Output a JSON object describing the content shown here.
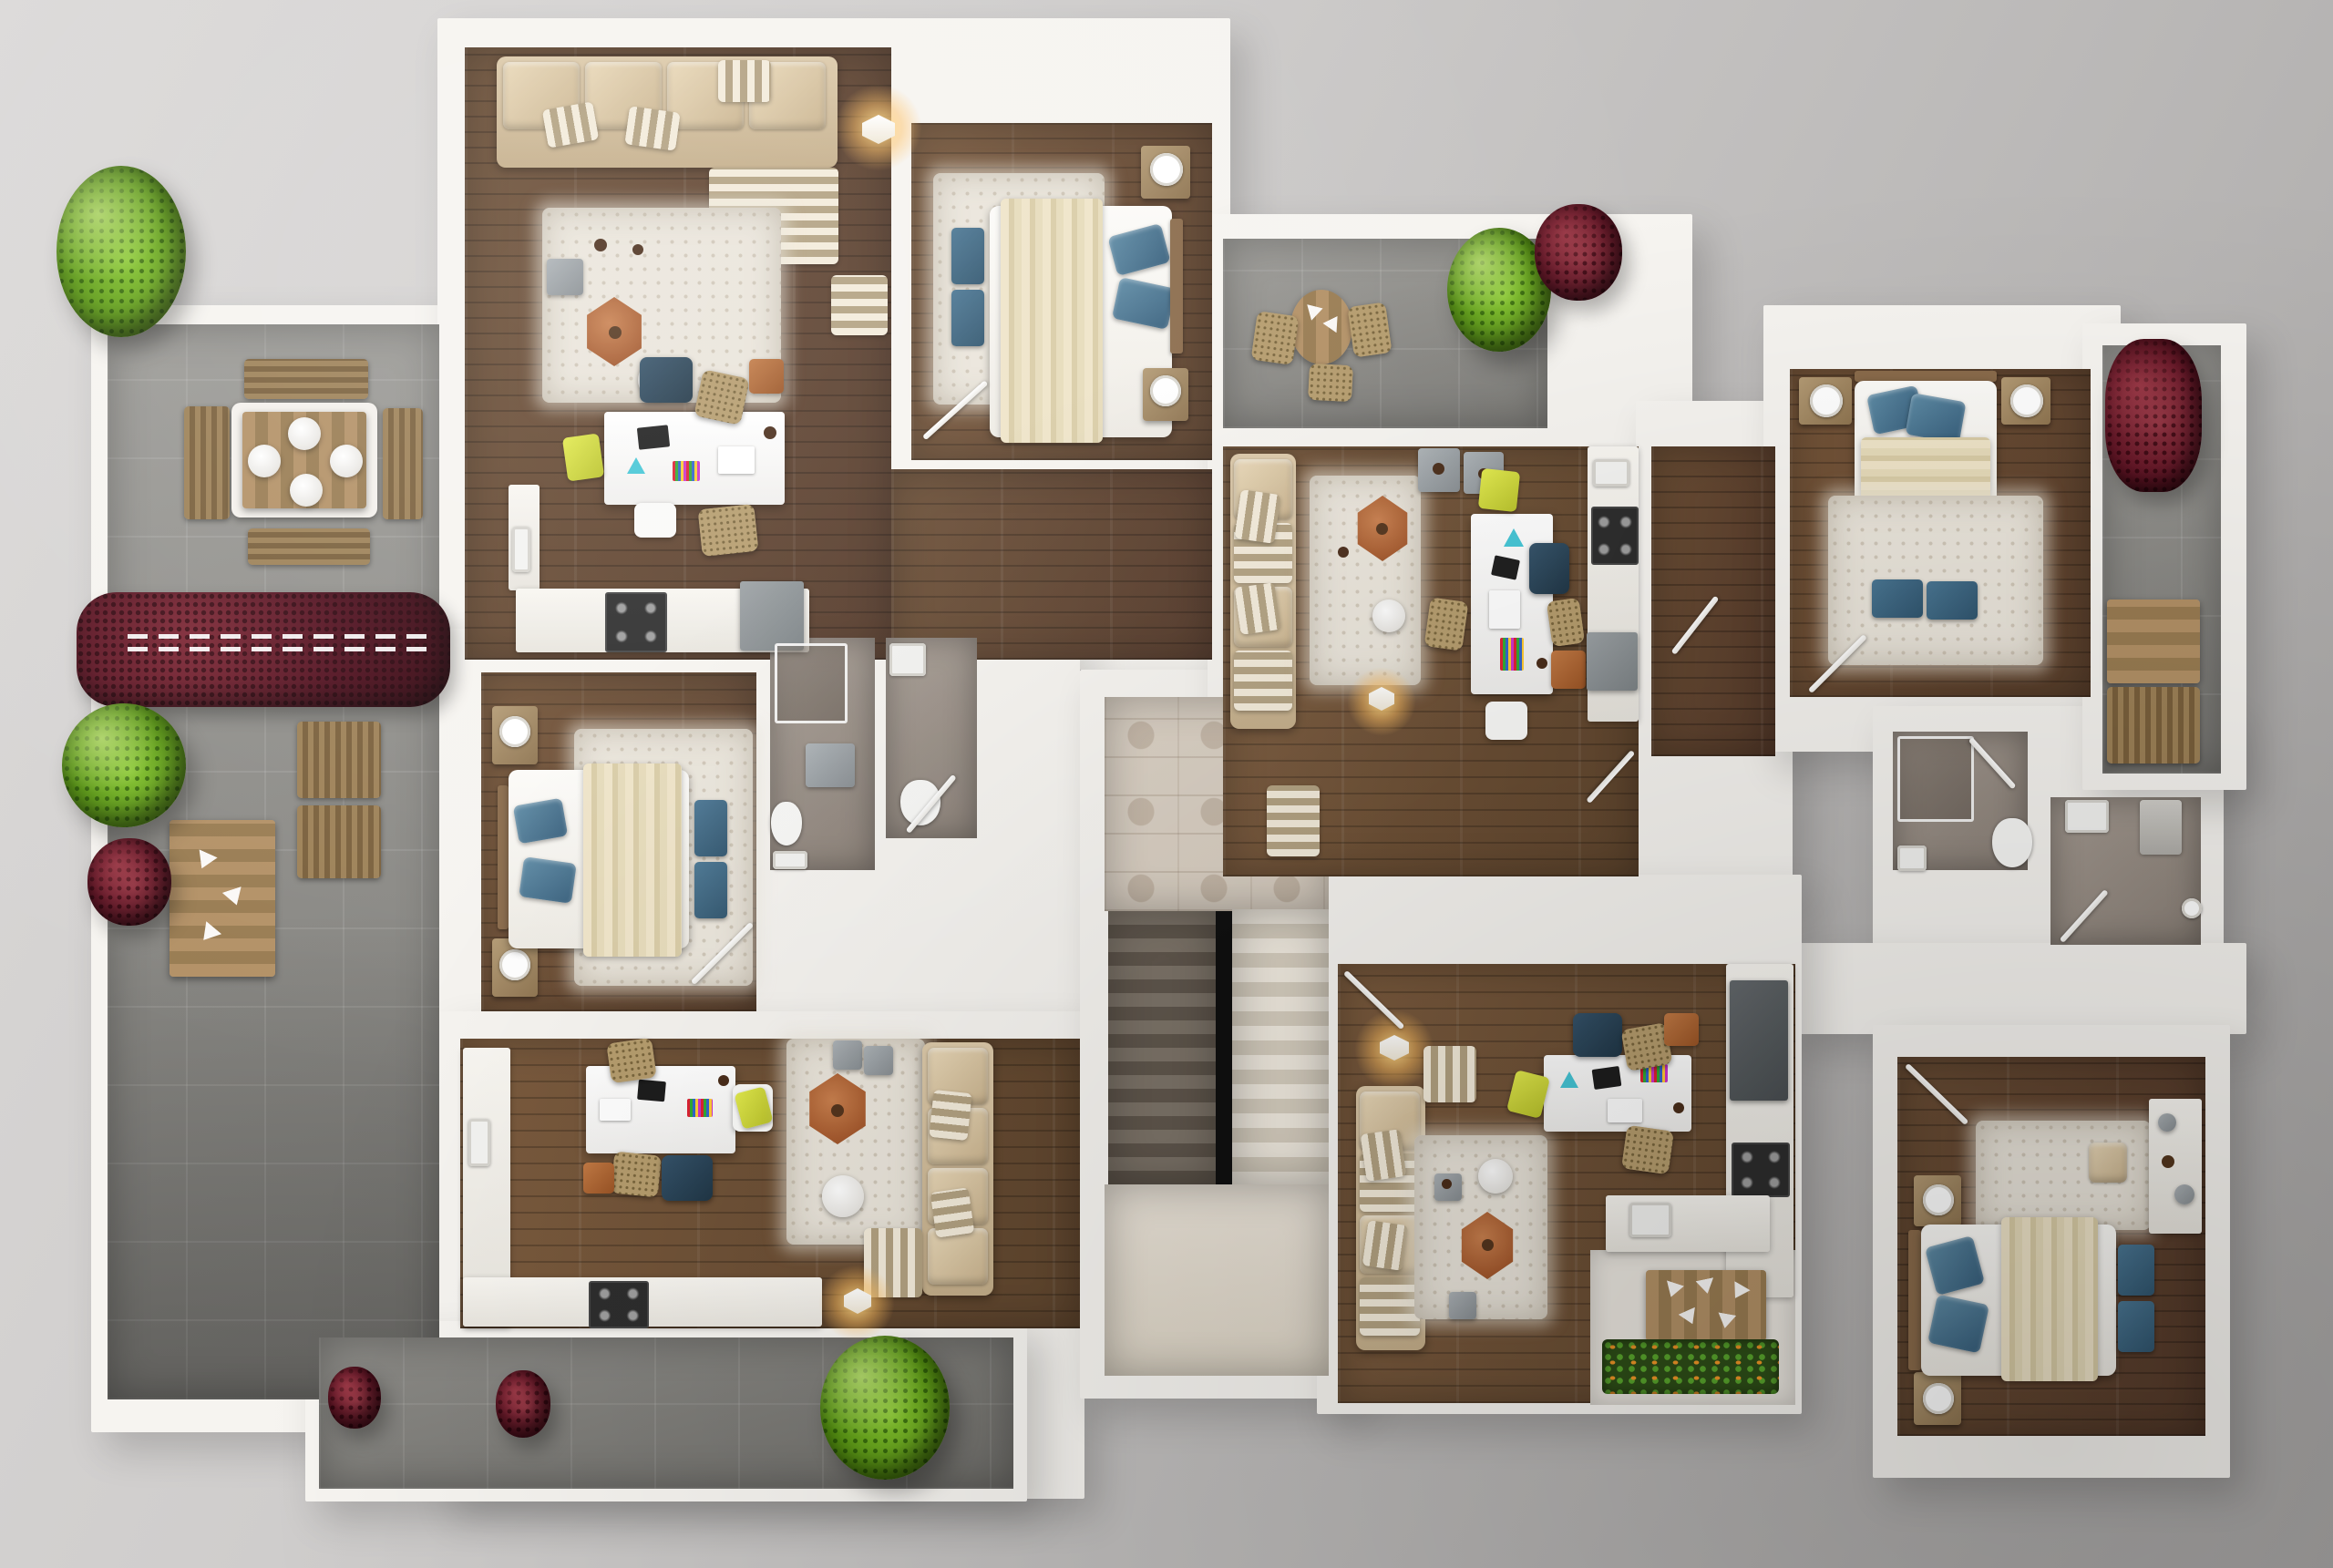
{
  "page": {
    "title": "3D Apartment Floor Plan — Top-Down Render"
  },
  "scene": {
    "kind": "photorealistic top-down 3D floor plan of a multi-apartment residential storey",
    "background_color": "#c6c4c3",
    "wall_color": "#f6f4f0",
    "no_visible_text": true
  },
  "palette": {
    "hardwood_dark": "#5f452f",
    "hardwood_mid": "#6d4f37",
    "hardwood_light": "#72543a",
    "terrace_tile_gray": "#8e8d89",
    "stair_hall_tile_beige": "#d9cfc2",
    "bathroom_floor_taupe": "#9a9088",
    "shag_rug_cream": "#eae5db",
    "sofa_beige": "#d5c1a1",
    "stripe_fabric": "#b2a181",
    "pillow_blue": "#44718f",
    "blanket_cream": "#e3d8ba",
    "coffee_table_terracotta": "#b06136",
    "accent_yellow": "#d8e03e",
    "accent_teal": "#45c6d6",
    "plant_green": "#65a415",
    "plant_dark_red": "#5e1323",
    "appliance_gray": "#8e9296",
    "stove_black": "#2d2d2d",
    "furniture_oak": "#a98d66"
  },
  "rooms": [
    {
      "id": "terrace-left",
      "floor": "gray tile",
      "contents": [
        "square dining table with 4 plates",
        "4 slat benches",
        "boxwood bushes",
        "red maple hedge with railing",
        "cube seats",
        "plank table"
      ]
    },
    {
      "id": "living-top-left",
      "floor": "hardwood",
      "contents": [
        "L-shaped beige sofa with striped pillows",
        "shag rug",
        "hexagonal terracotta coffee table",
        "white side table",
        "work desk with chairs",
        "wall lamp"
      ]
    },
    {
      "id": "bedroom-top-middle",
      "floor": "hardwood",
      "contents": [
        "double bed with blue pillows",
        "two nightstands with lamps",
        "shag rug",
        "two blue ottomans"
      ]
    },
    {
      "id": "kitchen-top-left",
      "floor": "hardwood",
      "contents": [
        "counter",
        "gas stove",
        "fridge"
      ]
    },
    {
      "id": "bedroom-left",
      "floor": "hardwood",
      "contents": [
        "double bed",
        "rug",
        "nightstands",
        "blue ottomans"
      ]
    },
    {
      "id": "bathroom-left-1",
      "floor": "taupe tile",
      "contents": [
        "shower",
        "vanity",
        "toilet",
        "sink"
      ]
    },
    {
      "id": "bathroom-left-2",
      "floor": "taupe tile",
      "contents": [
        "sink",
        "toilet"
      ]
    },
    {
      "id": "living-bottom-left",
      "floor": "hardwood",
      "contents": [
        "desk with chairs",
        "kitchen counters with stove",
        "rug",
        "hex coffee table",
        "L-sofa",
        "floor lamp"
      ]
    },
    {
      "id": "stair-hall",
      "floor": "beige tile",
      "contents": [
        "U-shaped staircase, two flights",
        "landing"
      ]
    },
    {
      "id": "terrace-top-right",
      "floor": "gray tile",
      "contents": [
        "round table",
        "wicker chairs",
        "green bush",
        "red plant"
      ]
    },
    {
      "id": "living-center-right",
      "floor": "hardwood",
      "contents": [
        "striped sofa",
        "rug",
        "hex table",
        "desk",
        "kitchen strip with stove and fridge",
        "floor lamp"
      ]
    },
    {
      "id": "bedroom-top-right",
      "floor": "hardwood",
      "contents": [
        "double bed",
        "nightstands with lamps",
        "rug",
        "blue ottomans"
      ]
    },
    {
      "id": "balcony-right",
      "floor": "gray tile",
      "contents": [
        "red plant",
        "wooden cabinets"
      ]
    },
    {
      "id": "bathroom-right-1",
      "floor": "taupe tile",
      "contents": [
        "shower",
        "toilet",
        "sink"
      ]
    },
    {
      "id": "bathroom-right-2",
      "floor": "taupe tile",
      "contents": [
        "sink",
        "boiler",
        "shower head"
      ]
    },
    {
      "id": "living-bottom-right",
      "floor": "hardwood",
      "contents": [
        "sofa",
        "rug",
        "hex table",
        "desk",
        "kitchen column",
        "island with sink",
        "balcony with planter"
      ]
    },
    {
      "id": "bedroom-bottom-right",
      "floor": "hardwood",
      "contents": [
        "double bed",
        "nightstands",
        "rug",
        "blue ottomans",
        "dresser"
      ]
    },
    {
      "id": "terrace-bottom",
      "floor": "gray tile",
      "contents": [
        "red plants",
        "green bush"
      ]
    }
  ]
}
